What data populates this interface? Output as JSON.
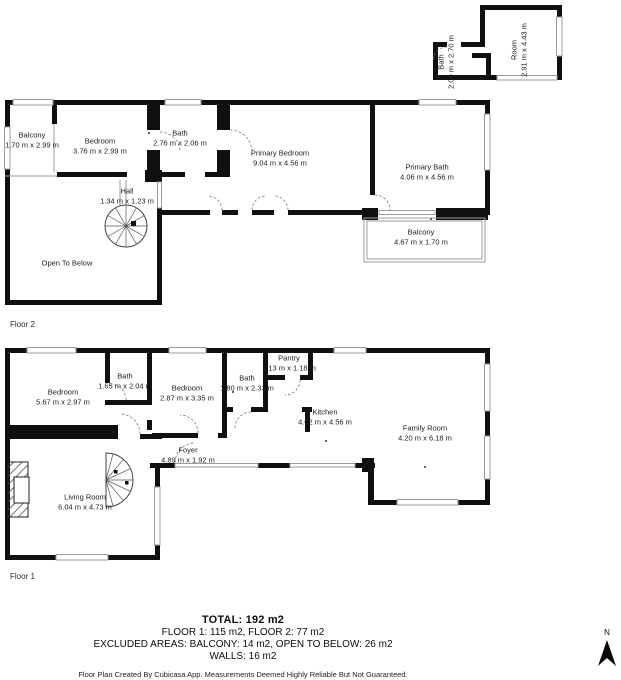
{
  "colors": {
    "wall": "#101010",
    "window_line": "#9c9c9c",
    "text": "#1c1c1c"
  },
  "attic": {
    "rooms": [
      {
        "name": "Bath",
        "dims": "2.00 m x 2.70 m"
      },
      {
        "name": "Room",
        "dims": "2.91 m x 4.43 m"
      }
    ]
  },
  "floor2": {
    "label": "Floor 2",
    "rooms": [
      {
        "name": "Balcony",
        "dims": "1.70 m x 2.99 m"
      },
      {
        "name": "Bedroom",
        "dims": "3.76 m x 2.99 m"
      },
      {
        "name": "Bath",
        "dims": "2.76 m x 2.06 m"
      },
      {
        "name": "Primary Bedroom",
        "dims": "9.04 m x 4.56 m"
      },
      {
        "name": "Primary Bath",
        "dims": "4.06 m x 4.56 m"
      },
      {
        "name": "Hall",
        "dims": "1.34 m x 1.23 m"
      },
      {
        "name": "Balcony",
        "dims": "4.67 m x 1.70 m"
      },
      {
        "name": "Open To Below",
        "dims": ""
      }
    ]
  },
  "floor1": {
    "label": "Floor 1",
    "rooms": [
      {
        "name": "Bedroom",
        "dims": "5.67 m x 2.97 m"
      },
      {
        "name": "Bath",
        "dims": "1.65 m x 2.04 m"
      },
      {
        "name": "Bedroom",
        "dims": "2.87 m x 3.35 m"
      },
      {
        "name": "Bath",
        "dims": "1.80 m x 2.33 m"
      },
      {
        "name": "Pantry",
        "dims": "1.13 m x 1.18 m"
      },
      {
        "name": "Kitchen",
        "dims": "4.02 m x 4.56 m"
      },
      {
        "name": "Family Room",
        "dims": "4.20 m x 6.18 m"
      },
      {
        "name": "Foyer",
        "dims": "4.89 m x 1.92 m"
      },
      {
        "name": "Living Room",
        "dims": "6.04 m x 4.73 m"
      }
    ]
  },
  "summary": {
    "total": "TOTAL: 192 m2",
    "floors": "FLOOR 1: 115 m2, FLOOR 2: 77 m2",
    "excluded": "EXCLUDED AREAS: BALCONY: 14 m2, OPEN TO BELOW: 26 m2",
    "walls": "WALLS: 16 m2",
    "disclaimer": "Floor Plan Created By Cubicasa App. Measurements Deemed Highly Reliable But Not Guaranteed."
  },
  "compass": {
    "label": "N"
  }
}
